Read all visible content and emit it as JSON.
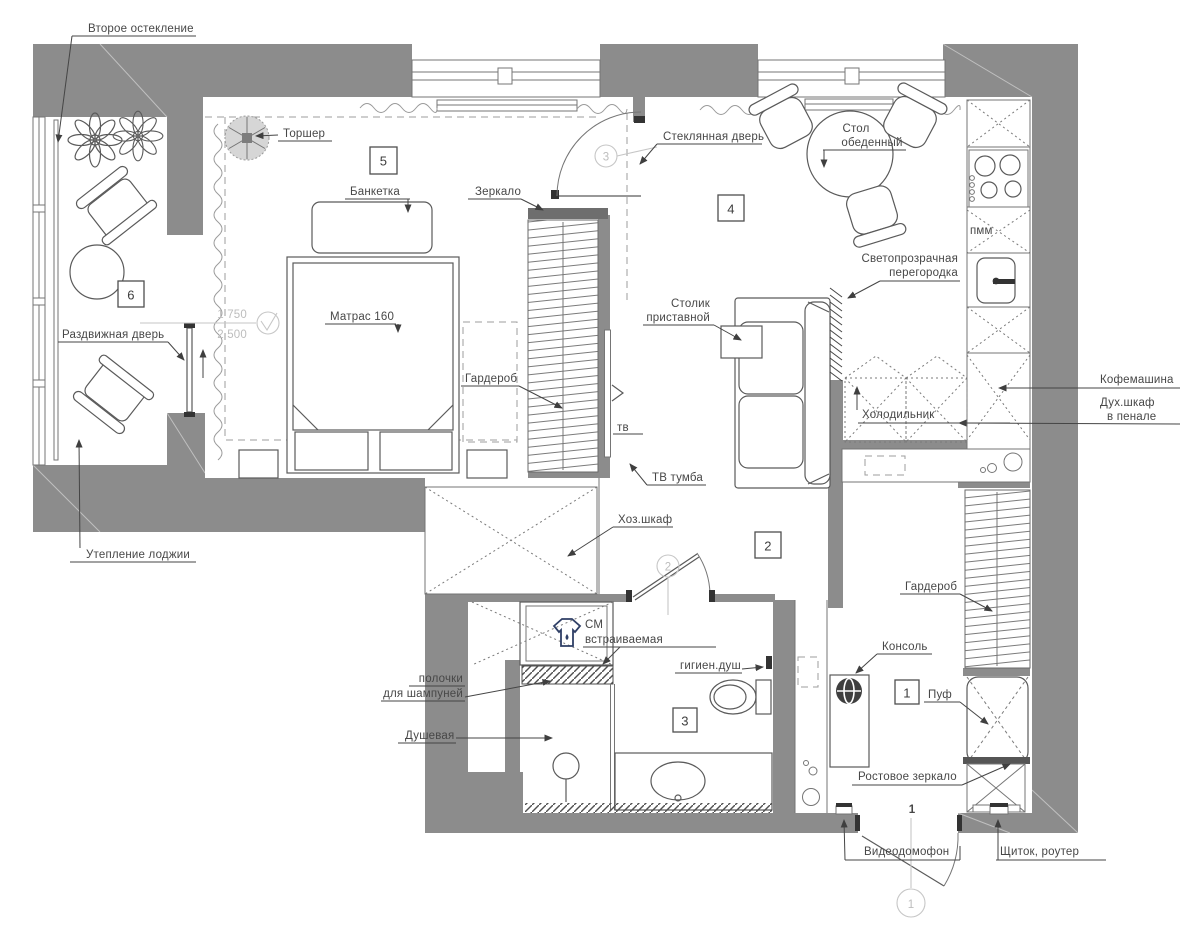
{
  "colors": {
    "wall": "#8c8c8c",
    "line": "#5a5a5a",
    "annotation": "#bdbdbd",
    "washer_icon": "#2f3f66"
  },
  "rooms": {
    "entry": "1",
    "hall": "2",
    "bath": "3",
    "living": "4",
    "bedroom": "5",
    "loggia": "6"
  },
  "door_markers": {
    "entry": "1",
    "bath": "2",
    "bedroom": "3"
  },
  "entry_big_number": "1",
  "dimensions": {
    "level_upper": "1 750",
    "level_lower": "2 500"
  },
  "labels": {
    "second_glazing": "Второе остекление",
    "loggia_insulation": "Утепление лоджии",
    "sliding_door": "Раздвижная дверь",
    "floor_lamp": "Торшер",
    "banquette": "Банкетка",
    "mattress": "Матрас 160",
    "mirror": "Зеркало",
    "wardrobe_bedroom": "Гардероб",
    "glass_door": "Стеклянная дверь",
    "dining_table": [
      "Стол",
      "обеденный"
    ],
    "partition": [
      "Светопрозрачная",
      "перегородка"
    ],
    "side_table": [
      "Столик",
      "приставной"
    ],
    "coffee_machine": "Кофемашина",
    "oven": [
      "Дух.шкаф",
      "в пенале"
    ],
    "fridge": "Холодильник",
    "dishwasher": "пмм",
    "tv_stand": "ТВ тумба",
    "tv": "тв",
    "utility_cabinet": "Хоз.шкаф",
    "washing_machine": [
      "СМ",
      "встраиваемая"
    ],
    "shampoo_shelves": [
      "полочки",
      "для шампуней"
    ],
    "shower": "Душевая",
    "hygienic_shower": "гигиен.душ",
    "console": "Консоль",
    "pouf": "Пуф",
    "wardrobe_entry": "Гардероб",
    "full_length_mirror": "Ростовое зеркало",
    "video_intercom": "Видеодомофон",
    "electrical_panel": "Щиток, роутер"
  }
}
